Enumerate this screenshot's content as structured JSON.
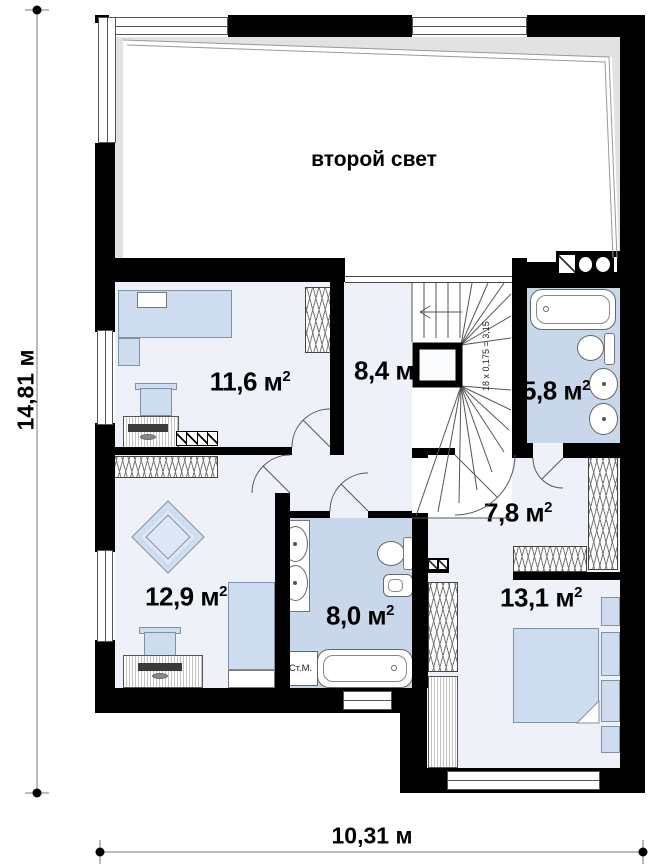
{
  "plan": {
    "second_light": "второй свет",
    "unit": "м",
    "sup": "2",
    "rooms": {
      "r116": {
        "area": "11,6"
      },
      "r84": {
        "area": "8,4"
      },
      "r58": {
        "area": "5,8"
      },
      "r129": {
        "area": "12,9"
      },
      "r80": {
        "area": "8,0"
      },
      "r78": {
        "area": "7,8"
      },
      "r131": {
        "area": "13,1"
      }
    },
    "stairs_note": "18 x 0,175 = 3,15",
    "washer_label": "Ст.М.",
    "dimensions": {
      "width": "10,31 м",
      "height": "14,81 м"
    },
    "colors": {
      "wall": "#000000",
      "bath_floor": "#c9d7ea",
      "room_floor": "#eef2f8",
      "furniture": "#cedcf0",
      "attic_gray": "#e2e2e2"
    }
  }
}
